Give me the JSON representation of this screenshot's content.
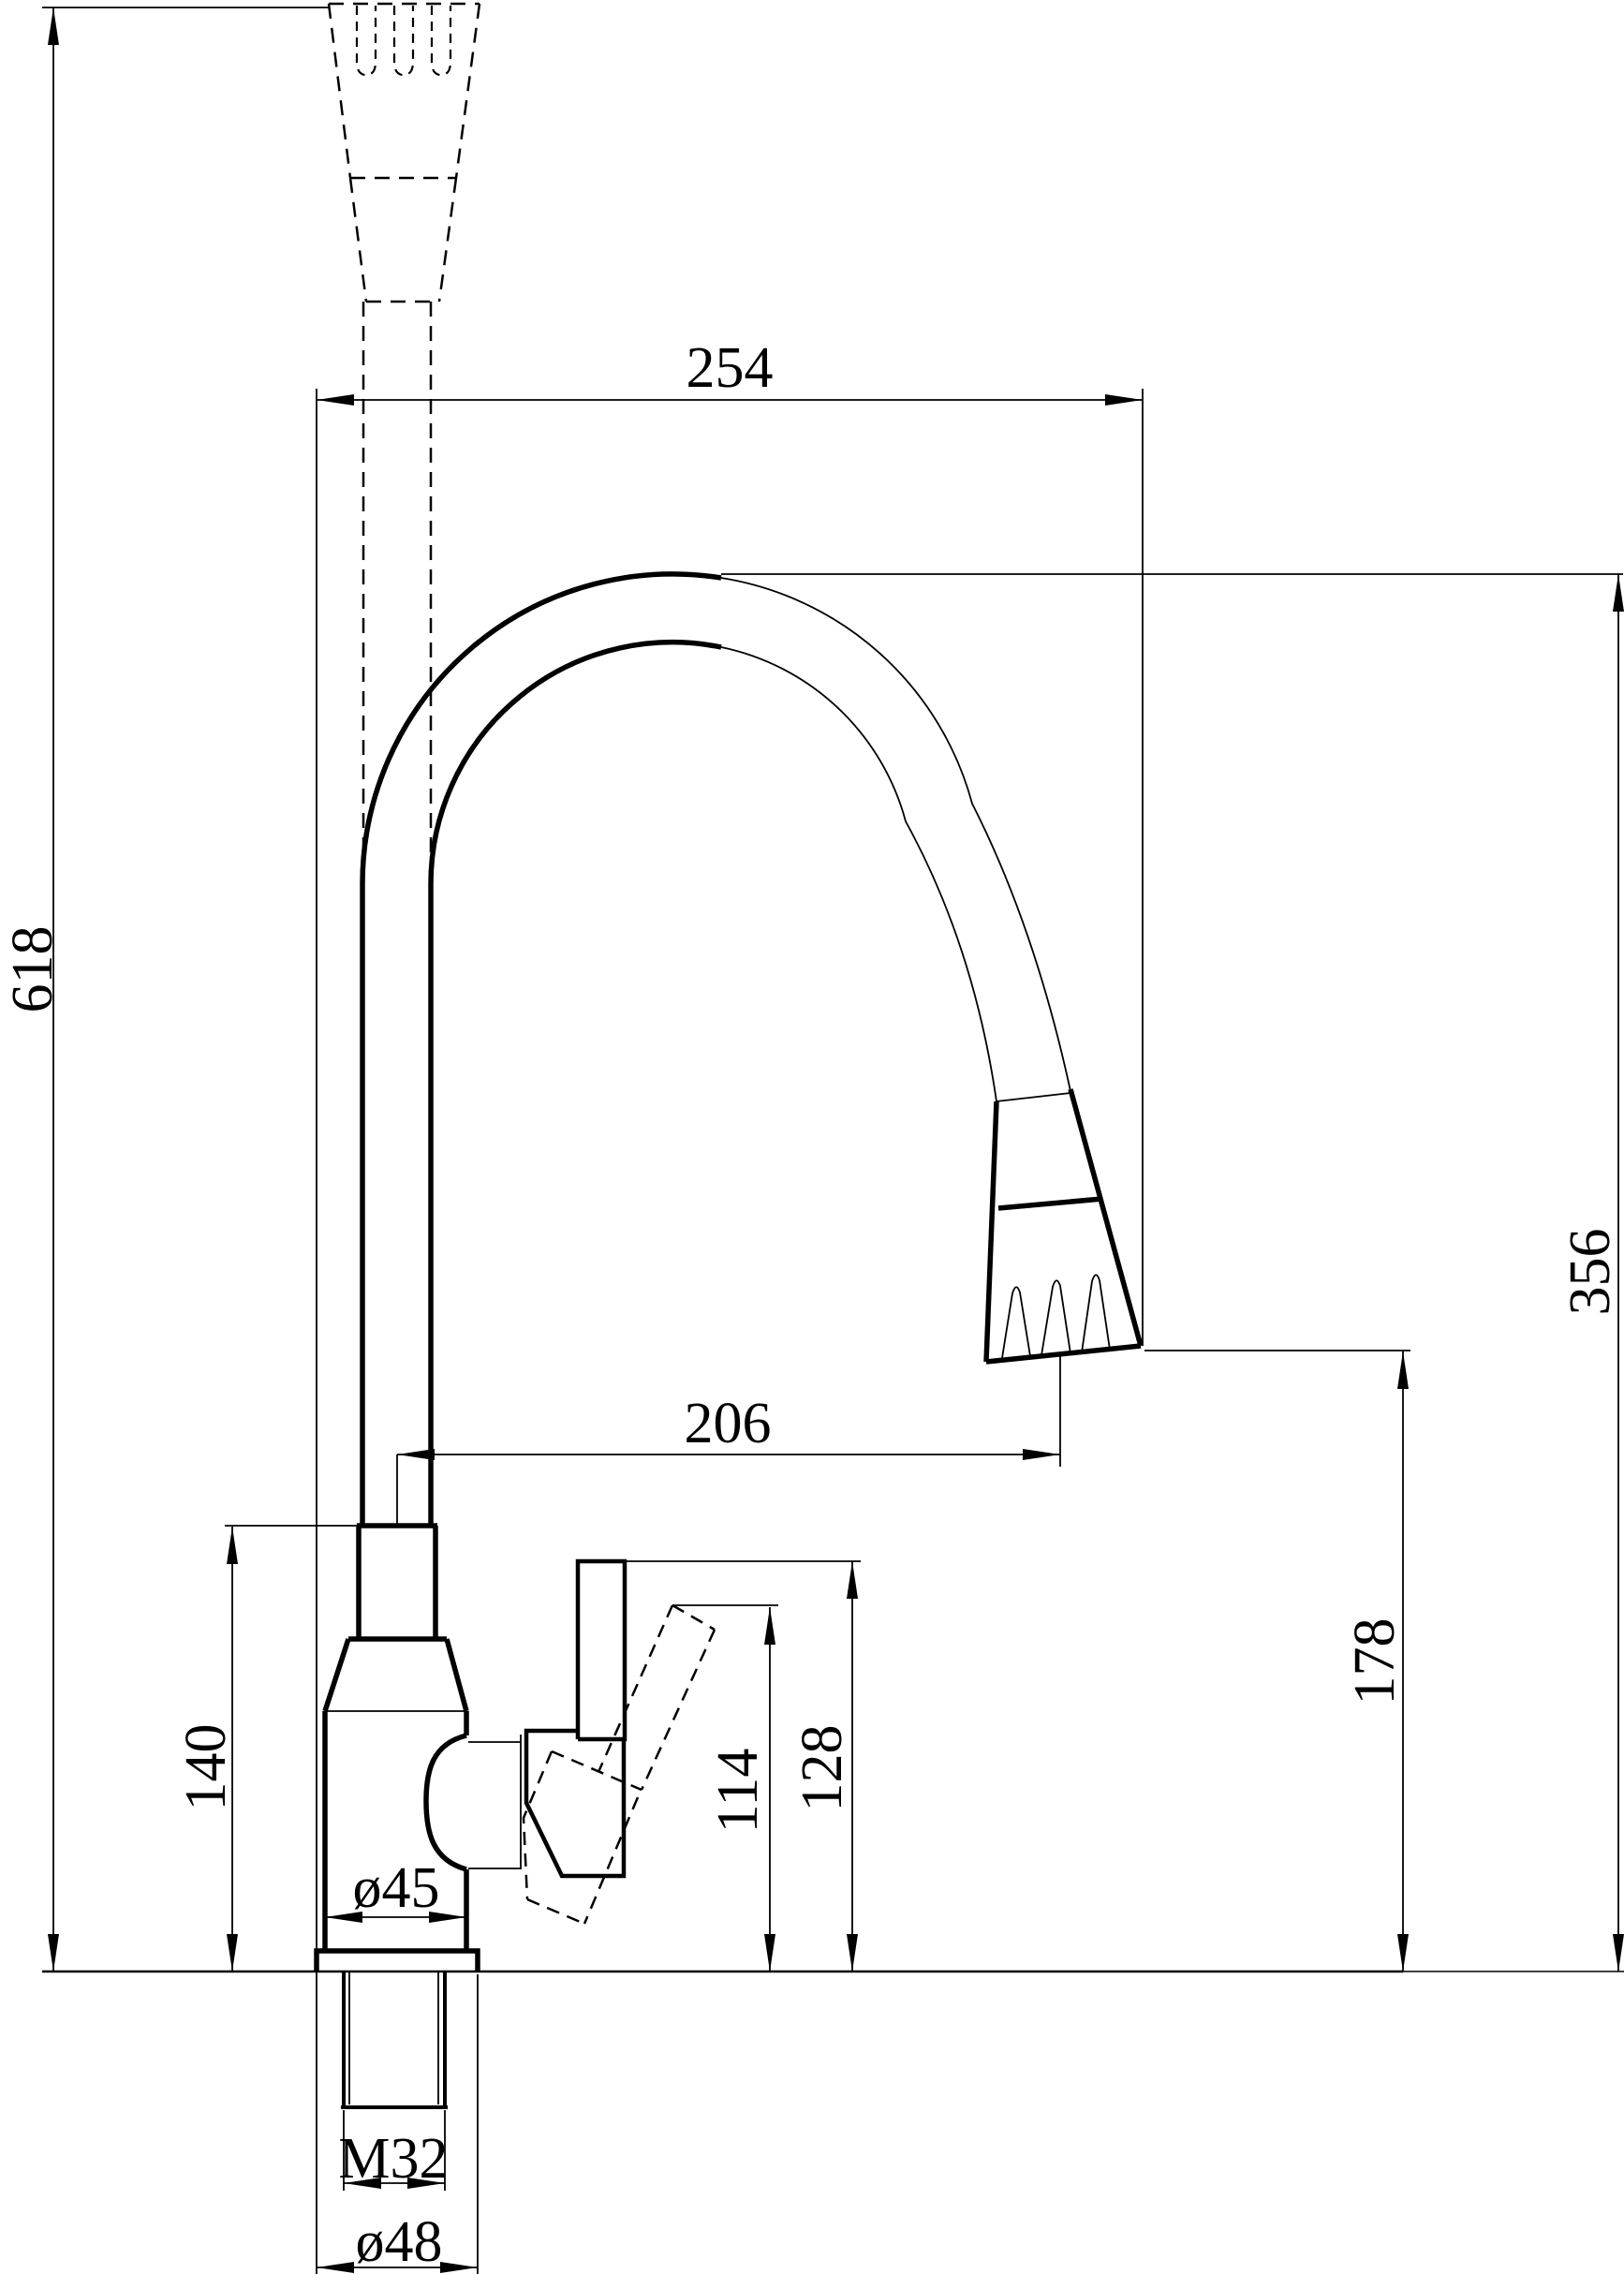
{
  "drawing": {
    "type": "faucet-technical-dimension-drawing",
    "background_color": "#ffffff",
    "line_color": "#000000"
  },
  "dims": {
    "d618": "618",
    "d254": "254",
    "d356": "356",
    "d206": "206",
    "d178": "178",
    "d140": "140",
    "d114": "114",
    "d128": "128",
    "d45": "ø45",
    "m32": "M32",
    "d48": "ø48"
  }
}
